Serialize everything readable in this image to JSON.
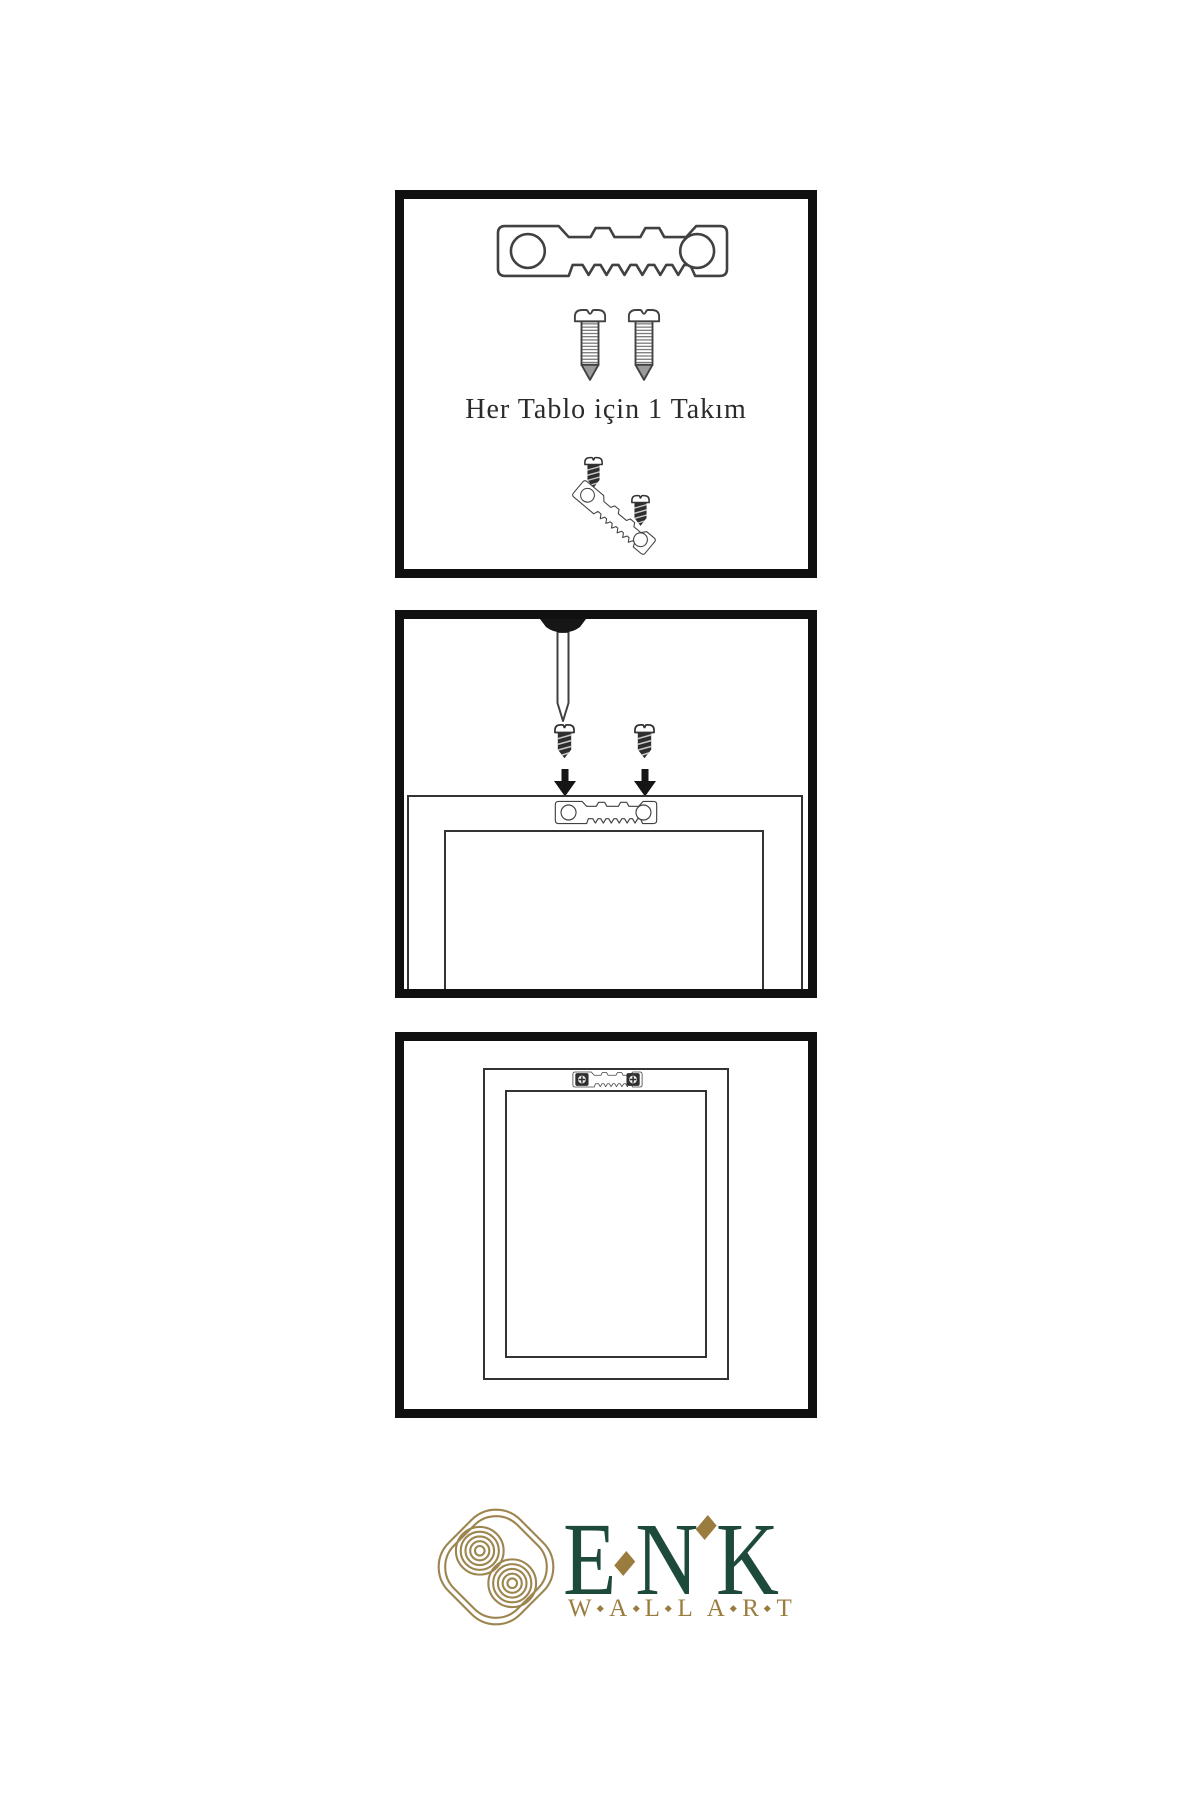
{
  "colors": {
    "background": "#ffffff",
    "line_art": "#414141",
    "panel_border": "#101010",
    "brand_green": "#1d4a3a",
    "brand_gold": "#9a7c3f",
    "icon_gold": "#9d8550"
  },
  "step1": {
    "caption": "Her Tablo için 1 Takım",
    "parts": [
      "sawtooth-hanger",
      "screw",
      "screw",
      "mini-screw",
      "angled-sawtooth-hanger",
      "mini-screw"
    ]
  },
  "step2": {
    "parts": [
      "wall-nail",
      "mini-screw-with-arrow",
      "mini-screw-with-arrow",
      "sawtooth-hanger-on-frame",
      "frame-back"
    ]
  },
  "step3": {
    "parts": [
      "frame-back",
      "mounted-sawtooth-hanger-with-screws"
    ]
  },
  "logo": {
    "brand": "ENK",
    "letters": [
      "E",
      "N",
      "K"
    ],
    "tagline": "WALL ART",
    "tagline_words": [
      [
        "W",
        "A",
        "L",
        "L"
      ],
      [
        "A",
        "R",
        "T"
      ]
    ],
    "icon": "interlaced-knot-icon"
  }
}
